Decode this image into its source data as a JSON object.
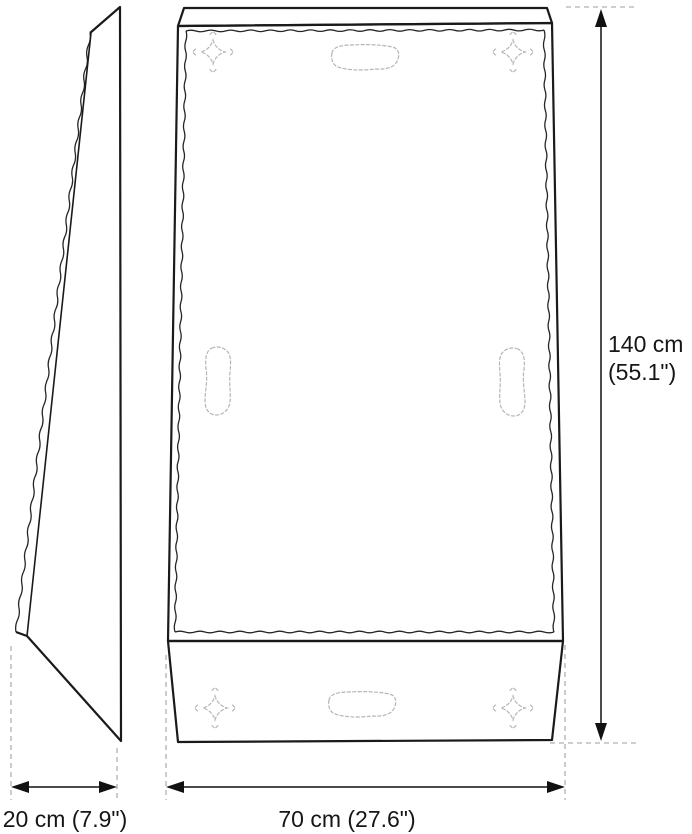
{
  "labels": {
    "depth": "20 cm (7.9\")",
    "width": "70 cm (27.6\")",
    "height_line1": "140 cm",
    "height_line2": "(55.1\")"
  },
  "colors": {
    "outline": "#1a1a1a",
    "wavy": "#262626",
    "dashed_detail": "#b5b5b5",
    "extension_line": "#b0b0b0",
    "text": "#161616",
    "background": "#ffffff"
  }
}
